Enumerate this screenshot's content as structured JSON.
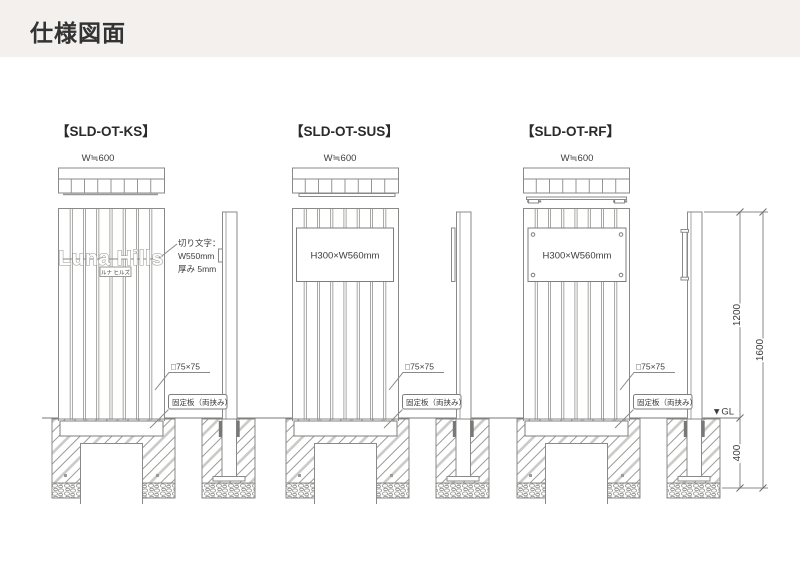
{
  "page": {
    "header_title": "仕様図面",
    "header_bg": "#f4f0ed",
    "line_color": "#8a8a88"
  },
  "annotations": {
    "post_size": "□75×75",
    "fixing_plate": "固定板（両挟み）"
  },
  "dimensions": {
    "above_ground": "1200",
    "total_height": "1600",
    "below_ground": "400",
    "ground_label": "▼GL"
  },
  "drawings": [
    {
      "title": "【SLD-OT-KS】",
      "width_label": "W≒600",
      "sign_text": "Luna Hills",
      "sign_reading": "ルナ ヒルズ",
      "note_lines": [
        "切り文字：",
        "W550mm",
        "厚み 5mm"
      ]
    },
    {
      "title": "【SLD-OT-SUS】",
      "width_label": "W≒600",
      "plate_label": "H300×W560mm"
    },
    {
      "title": "【SLD-OT-RF】",
      "width_label": "W≒600",
      "plate_label": "H300×W560mm"
    }
  ]
}
